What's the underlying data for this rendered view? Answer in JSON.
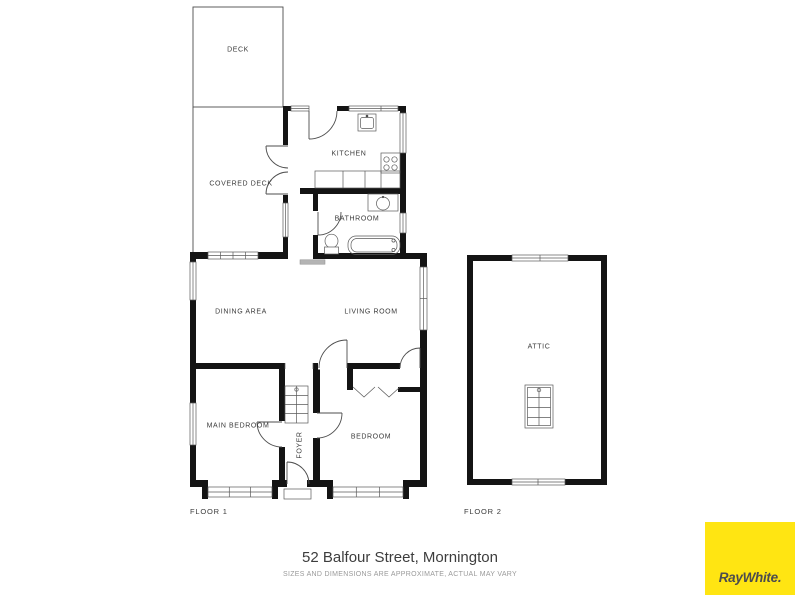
{
  "meta": {
    "address": "52 Balfour Street, Mornington",
    "disclaimer": "SIZES AND DIMENSIONS ARE APPROXIMATE, ACTUAL MAY VARY"
  },
  "floors": {
    "floor1_label": "FLOOR 1",
    "floor2_label": "FLOOR 2"
  },
  "rooms": {
    "deck": "DECK",
    "covered_deck": "COVERED DECK",
    "kitchen": "KITCHEN",
    "bathroom": "BATHROOM",
    "dining": "DINING AREA",
    "living": "LIVING ROOM",
    "main_bedroom": "MAIN BEDROOM",
    "foyer": "FOYER",
    "bedroom": "BEDROOM",
    "attic": "ATTIC"
  },
  "branding": {
    "logo_text": "RayWhite.",
    "logo_bg": "#FFE512",
    "logo_fg": "#4C4C4E"
  },
  "colors": {
    "wall": "#141414",
    "thin_line": "#4D4D4D",
    "mat": "#B4B4B4",
    "background": "#FFFFFF"
  }
}
